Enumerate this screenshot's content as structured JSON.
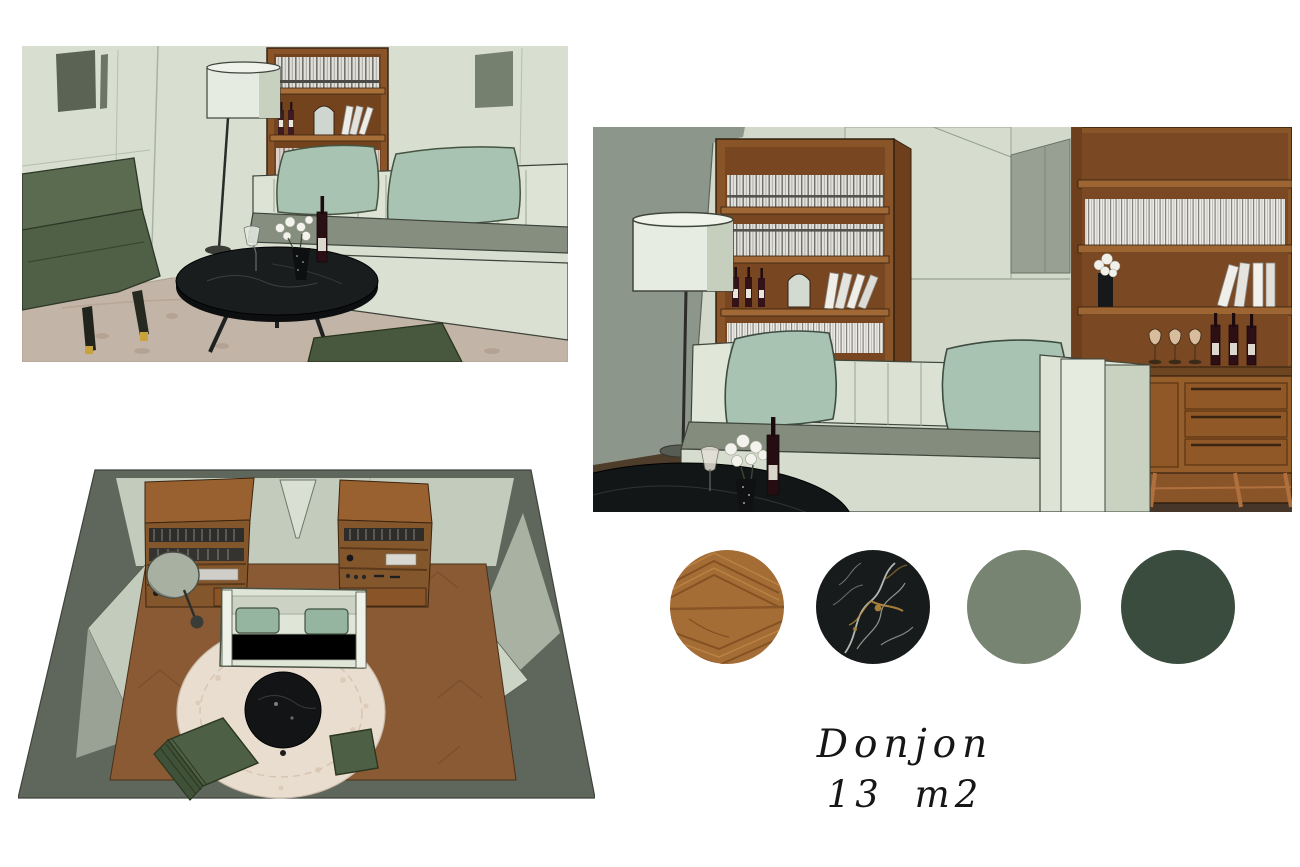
{
  "board": {
    "background": "#ffffff",
    "title": {
      "line1": "Donjon",
      "line2": "13 m2"
    }
  },
  "renders": [
    {
      "name": "perspective-view-closeup",
      "description": "3D render: lounge corner with green armchair, round black marble coffee table with wine and white roses, white drum floor lamp, wood bookcase and sage banquette with two green cushions"
    },
    {
      "name": "perspective-view-wide",
      "description": "3D render: sofa wall with two wood bookcases, white drum floor lamp, sage sofa with two green cushions, black marble table and drinks sideboard with wine bottles and glasses"
    },
    {
      "name": "top-down-view",
      "description": "3D render: aerial plan of the room with herringbone wood floor, round cream rug, black round table, sofa, two bookcases, armchair and ottoman"
    }
  ],
  "palette": {
    "swatches": [
      {
        "name": "wood-parquet",
        "color": "#a56d36"
      },
      {
        "name": "black-marble",
        "color": "#171b1c"
      },
      {
        "name": "sage-green",
        "color": "#778471"
      },
      {
        "name": "forest-green",
        "color": "#3a4c3e"
      }
    ],
    "accents": {
      "wall_light_sage": "#d8dfd1",
      "wall_gray_green": "#8d968b",
      "cushion_sage": "#a9c3b3",
      "armchair_green": "#52634a",
      "wood_shelf": "#8a5429",
      "rug_cream": "#e9ddd0"
    }
  }
}
